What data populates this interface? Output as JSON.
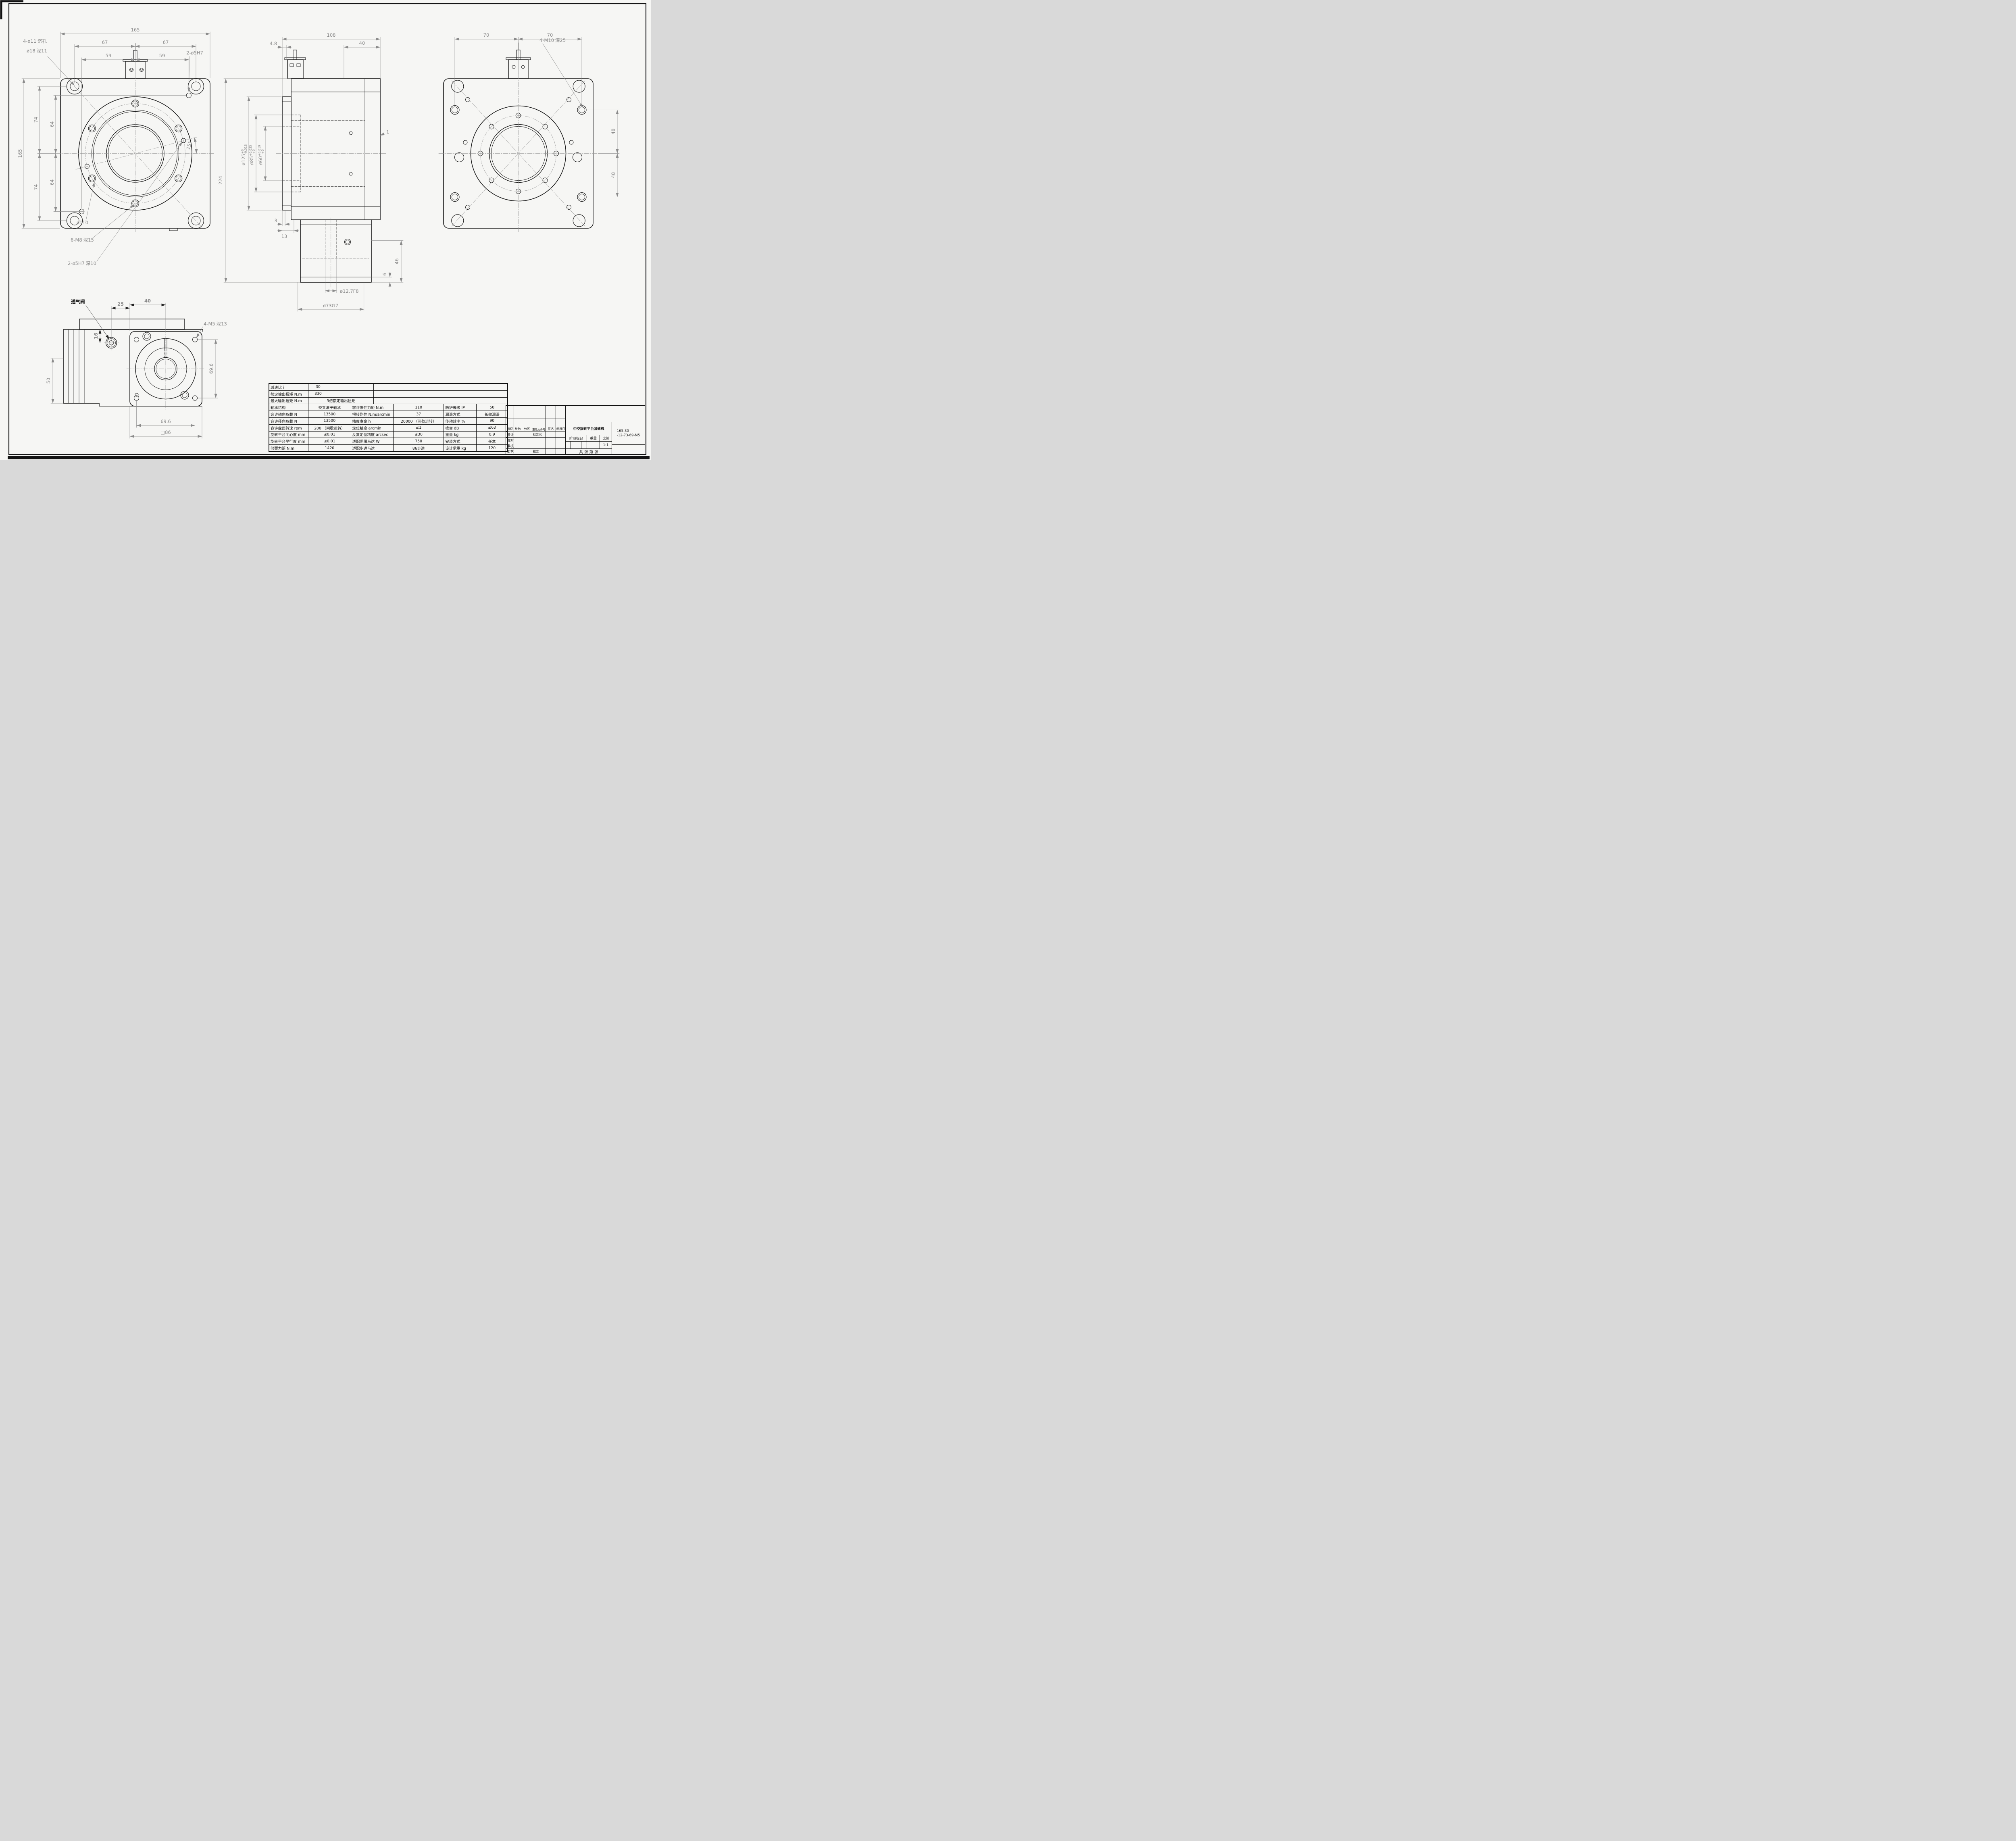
{
  "front_view": {
    "cb1a": "4-ø11",
    "cb1b": "沉孔",
    "cb2a": "ø18",
    "cb2b": "深",
    "cb2c": "11",
    "pin_top": "2-ø5H7",
    "dia110": "ø110",
    "m8a": "6-M8",
    "m8b": "深",
    "m8c": "15",
    "pinb_a": "2-ø5H7",
    "pinb_b": "深",
    "pinb_c": "10",
    "d165t": "165",
    "d67a": "67",
    "d67b": "67",
    "d59a": "59",
    "d59b": "59",
    "d165l": "165",
    "d74a": "74",
    "d74b": "74",
    "d64a": "64",
    "d64b": "64",
    "ang15": "15°"
  },
  "side_view": {
    "d108": "108",
    "d48": "4.8",
    "d40": "40",
    "d125": "ø125",
    "d125u": "+0",
    "d125l": "-0.018",
    "d85": "ø85",
    "d85u": "+0.035",
    "d85l": "+0",
    "d60": "ø60",
    "d60u": "+0.019",
    "d60l": "+0",
    "d3": "3",
    "d13": "13",
    "d224": "224",
    "d46": "46",
    "d6": "6",
    "d1": "1",
    "d127": "ø12.7F8",
    "d73": "ø73G7"
  },
  "back_view": {
    "d70a": "70",
    "d70b": "70",
    "m10a": "4-M10",
    "m10b": "深",
    "m10c": "25",
    "d48a": "48",
    "d48b": "48"
  },
  "bottom_view": {
    "valve": "透气阀",
    "d25": "25",
    "d40": "40",
    "d16": "16",
    "d50": "50",
    "m5a": "4-M5",
    "m5b": "深",
    "m5c": "13",
    "d696v": "69.6",
    "d696h": "69.6",
    "dsq86": "□86"
  },
  "spec_table": {
    "r1": {
      "label": "减速比 i",
      "value": "30"
    },
    "r2": {
      "label": "额定输出扭矩 N.m",
      "value": "330"
    },
    "r3": {
      "label": "最大输出扭矩 N.m",
      "value": "3倍额定输出扭矩"
    },
    "rows": [
      [
        "轴承结构",
        "交叉滚子轴承",
        "容许惯性力矩 N.m",
        "110",
        "防护等级 IP",
        "50"
      ],
      [
        "容许轴向负载 N",
        "13500",
        "扭转刚性 N.m/arcmin",
        "37",
        "润滑方式",
        "长效润滑"
      ],
      [
        "容许径向负载 N",
        "13500",
        "精度寿命 h",
        "20000 （间歇运转）",
        "传动效率 %",
        "90"
      ],
      [
        "容许盘面转速 rpm",
        "200 （间歇运转）",
        "定位精度 arcmin",
        "≤1",
        "噪音 dB",
        "≤63"
      ],
      [
        "旋转平台同心度 mm",
        "≤0.01",
        "反复定位精度 arcsec",
        "≤30",
        "重量 kg",
        "8.9"
      ],
      [
        "旋转平台平行度 mm",
        "≤0.01",
        "适配伺服马达 W",
        "750",
        "安装方式",
        "任意"
      ],
      [
        "倾覆力矩 N.m",
        "1420",
        "适配步进马达",
        "86步进",
        "设计承重 kg",
        "120"
      ]
    ]
  },
  "title_block": {
    "rev_headers": [
      "标记",
      "处数",
      "分区",
      "更改文件号",
      "签名",
      "年月日"
    ],
    "sig1": "设计",
    "sig2": "校对",
    "sig3": "审核",
    "sig4": "工艺",
    "std_label": "标准化",
    "approve_label": "批准",
    "title": "中空旋转平台减速机",
    "part_no1": "165-30",
    "part_no2": "-12-73-69-M5",
    "stage": "阶段标记",
    "weight": "重量",
    "scale": "比例",
    "scale_val": "1:1",
    "sheet_note": "共 张 第 张"
  }
}
